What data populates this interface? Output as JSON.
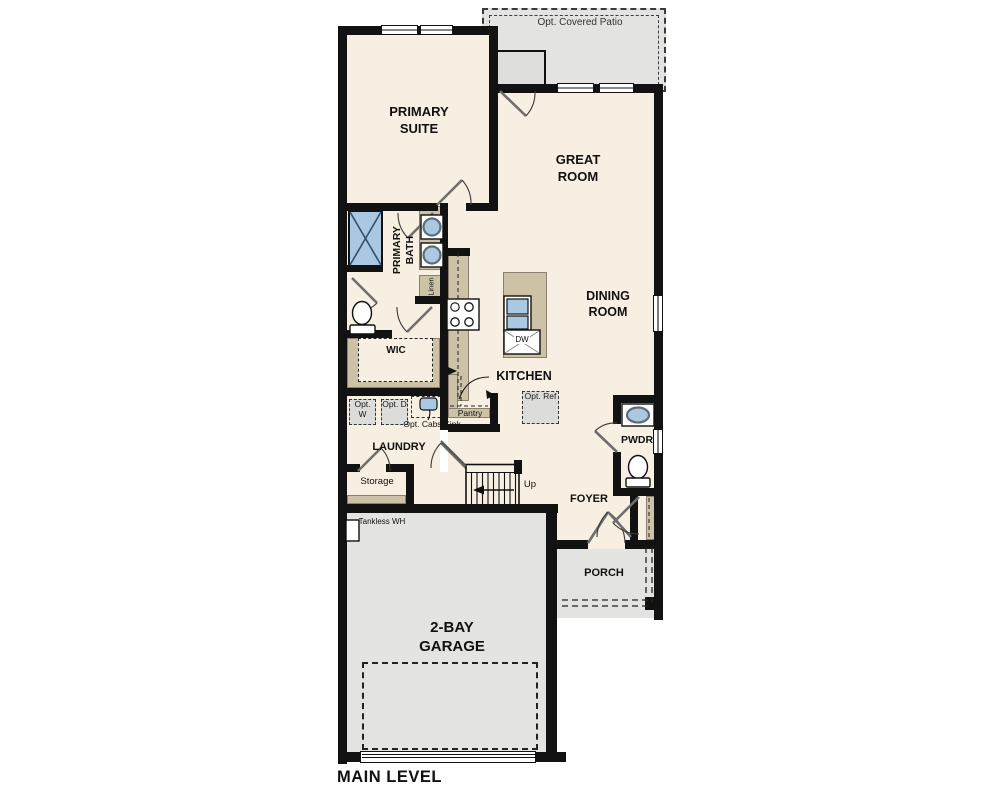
{
  "title": "Floor plan — Main Level",
  "colors": {
    "floor_cream": "#f7efe1",
    "floor_gray": "#e3e3e1",
    "counter_tan": "#cec2a6",
    "wall_black": "#121212",
    "fixture_blue": "#abc8e2",
    "appliance_gray": "#dcdcda"
  },
  "labels": {
    "patio": "Opt. Covered Patio",
    "primary_suite": "PRIMARY SUITE",
    "great_room": "GREAT ROOM",
    "dining_room": "DINING ROOM",
    "primary_bath": "PRIMARY BATH",
    "linen": "Linen",
    "wic": "WIC",
    "kitchen": "KITCHEN",
    "dw": "DW",
    "pantry": "Pantry",
    "opt_ref": "Opt. Ref",
    "opt_w": "Opt. W",
    "opt_d": "Opt. D",
    "opt_cabs_sink": "Opt. Cabs/Sink",
    "laundry": "LAUNDRY",
    "storage": "Storage",
    "up": "Up",
    "foyer": "FOYER",
    "pwdr": "PWDR",
    "porch": "PORCH",
    "tankless_wh": "Tankless WH",
    "garage": "2-BAY GARAGE",
    "main_level": "MAIN LEVEL"
  }
}
